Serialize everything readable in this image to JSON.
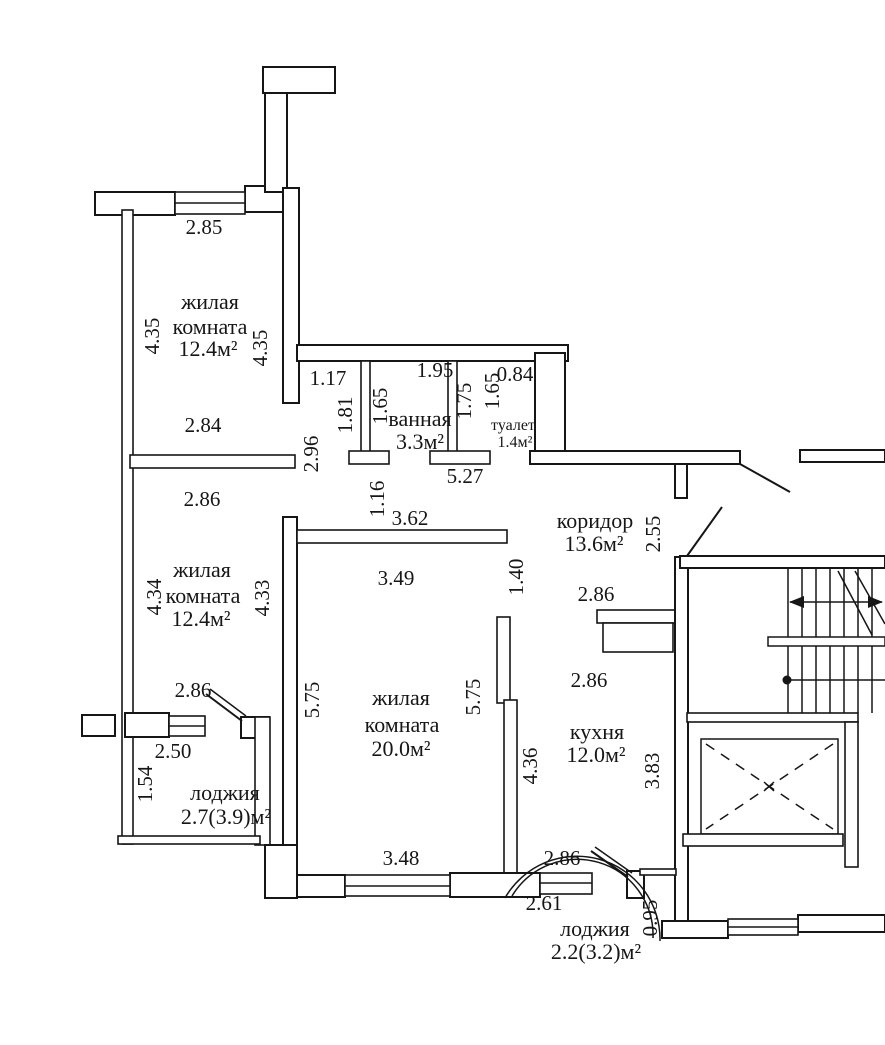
{
  "document_type": "apartment-floor-plan",
  "colors": {
    "ink": "#161616",
    "paper": "#ffffff"
  },
  "rooms": {
    "living_top": {
      "line1": "жилая",
      "line2": "комната",
      "area": "12.4м²"
    },
    "living_mid": {
      "line1": "жилая",
      "line2": "комната",
      "area": "12.4м²"
    },
    "living_large": {
      "line1": "жилая",
      "line2": "комната",
      "area": "20.0м²"
    },
    "bathroom": {
      "name": "ванная",
      "area": "3.3м²"
    },
    "toilet": {
      "name": "туалет",
      "area": "1.4м²"
    },
    "corridor": {
      "name": "коридор",
      "area": "13.6м²"
    },
    "kitchen": {
      "name": "кухня",
      "area": "12.0м²"
    },
    "loggia_left": {
      "name": "лоджия",
      "area": "2.7(3.9)м²"
    },
    "loggia_bottom": {
      "name": "лоджия",
      "area": "2.2(3.2)м²"
    }
  },
  "dims": {
    "room_a_top": "2.85",
    "room_a_left": "4.35",
    "room_a_right": "4.35",
    "room_a_bottom": "2.84",
    "niche_top": "1.17",
    "bath_top": "1.95",
    "wc_top": "0.84",
    "niche_left": "1.81",
    "bath_left": "1.65",
    "bath_right": "1.75",
    "wc_left": "1.65",
    "corridor_left_v": "2.96",
    "hall_top_width": "5.27",
    "niche_bottom_v": "1.16",
    "corridor_top_width": "3.62",
    "room_b_top": "2.86",
    "room_b_left": "4.34",
    "room_b_right": "4.33",
    "room_b_bottom": "2.86",
    "room_c_top": "3.49",
    "room_c_door_v": "1.40",
    "room_c_left": "5.75",
    "room_c_right": "5.75",
    "room_c_bottom": "3.48",
    "corridor_right_v": "2.55",
    "corridor_bottom": "2.86",
    "kitchen_top": "2.86",
    "kitchen_left_v": "4.36",
    "kitchen_right_v": "3.83",
    "kitchen_bottom": "2.86",
    "loggia_left_width": "2.50",
    "loggia_left_depth": "1.54",
    "loggia_bottom_width": "2.61",
    "loggia_bottom_depth": "0.95"
  }
}
